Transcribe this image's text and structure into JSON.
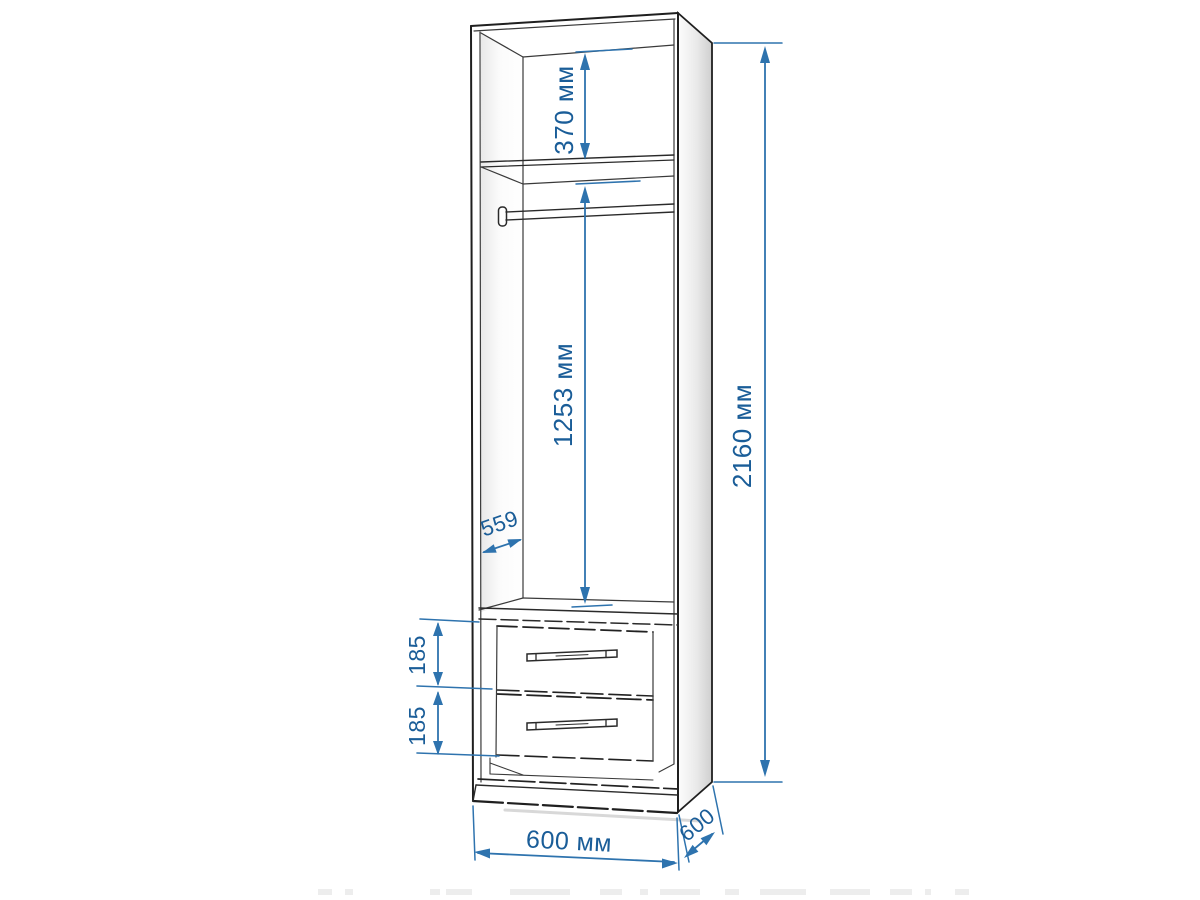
{
  "palette": {
    "background": "#ffffff",
    "outline": "#1f1f1f",
    "inner_line": "#3a3a3a",
    "dimension_line": "#2e73ae",
    "dimension_text": "#1a5d98",
    "side_panel_shade": "#d4d4d4"
  },
  "dimensions": {
    "upper_compartment_height": {
      "label": "370 мм"
    },
    "hanging_space_height": {
      "label": "1253 мм"
    },
    "overall_height": {
      "label": "2160 мм"
    },
    "interior_depth": {
      "label": "559"
    },
    "upper_drawer_height": {
      "label": "185"
    },
    "lower_drawer_height": {
      "label": "185"
    },
    "overall_width": {
      "label": "600 мм"
    },
    "overall_depth": {
      "label": "600"
    }
  }
}
